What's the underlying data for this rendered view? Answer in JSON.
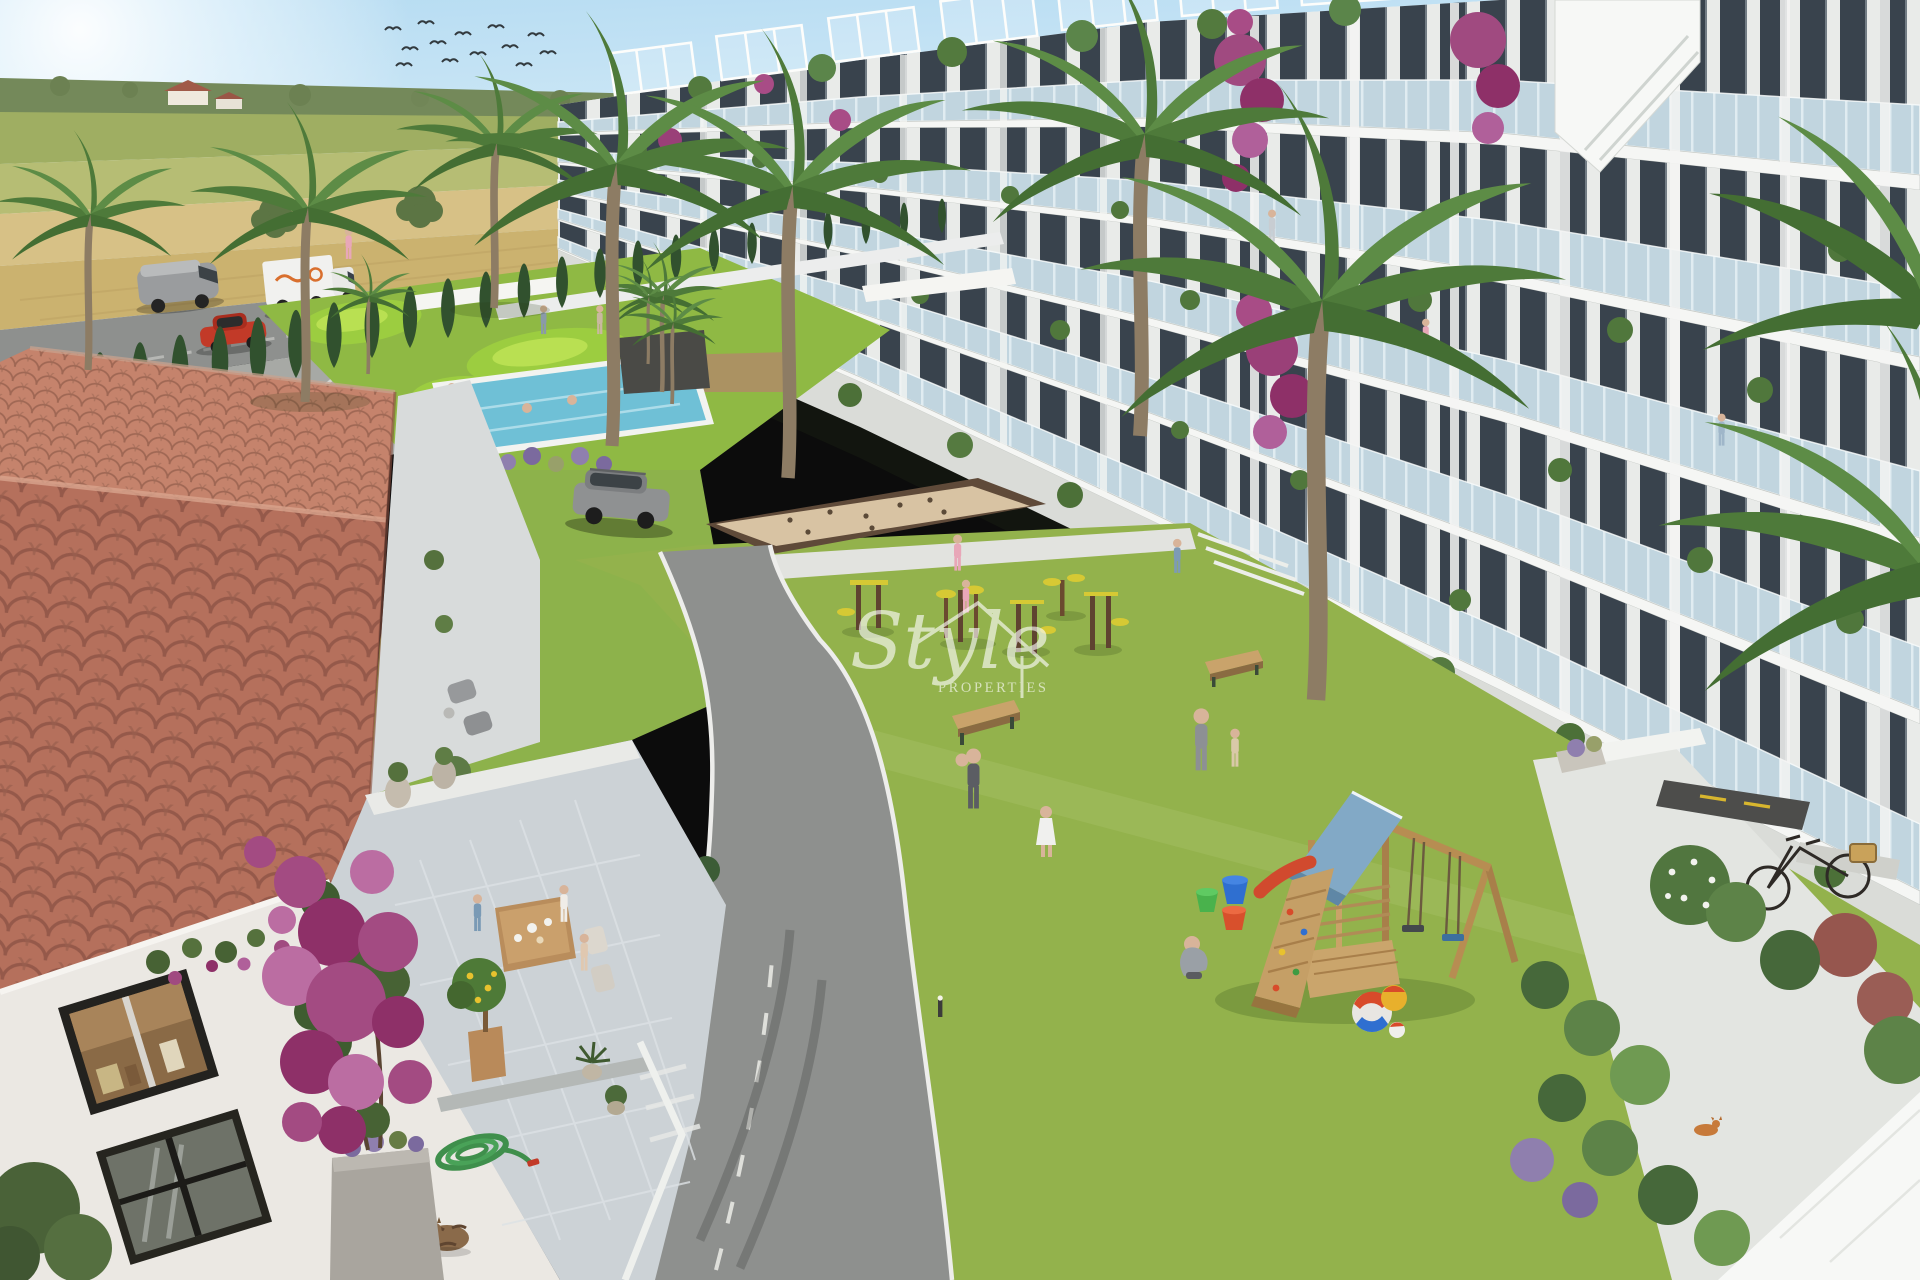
{
  "watermark": {
    "script": "Style",
    "caps": "PROPERTIES"
  },
  "palette": {
    "sky": "#c3e0f2",
    "field_green": "#a3b168",
    "wheat": "#d7c186",
    "asphalt": "#8e908e",
    "parking": "#a7a9a5",
    "lawn": "#93b24c",
    "golf": "#8fb944",
    "pool": "#6fc0d6",
    "sand": "#d8c3a3",
    "building": "#f3f4f2",
    "glass": "#b7cfdb",
    "window_dark": "#39434d",
    "roof_tile": "#b5705c",
    "roof_tile_light": "#c5836c",
    "terrace": "#d2d7da",
    "cypress": "#31512e",
    "palm": "#4e7a3a",
    "bougainvillea": "#a84c86",
    "wood": "#c7a066",
    "play_roof": "#82a9c6",
    "accent_yellow": "#d6c934",
    "van_gray": "#9a9c9e",
    "truck_white": "#f1f1ef",
    "car_red": "#c23a28",
    "suv_gray": "#8f9192"
  }
}
